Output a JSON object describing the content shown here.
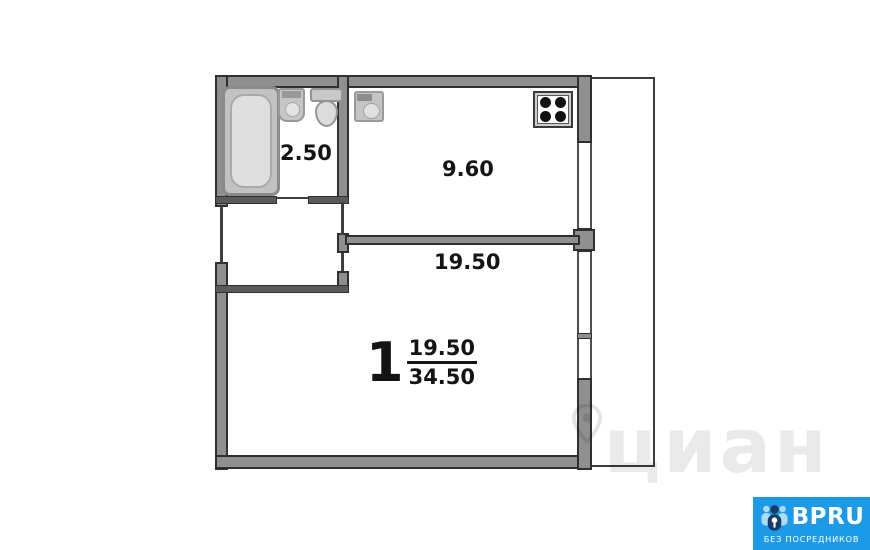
{
  "plan": {
    "rooms": [
      {
        "name": "bathroom",
        "area": "2.50"
      },
      {
        "name": "kitchen",
        "area": "9.60"
      },
      {
        "name": "living-room",
        "area": "19.50"
      }
    ],
    "summary": {
      "room_count": "1",
      "living_area": "19.50",
      "total_area": "34.50"
    },
    "fixtures": [
      "bathtub-icon",
      "washbasin-icon",
      "toilet-icon",
      "kitchen-sink-icon",
      "stove-icon"
    ]
  },
  "watermark": {
    "text": "циан",
    "icon": "location-pin-icon"
  },
  "logo": {
    "brand": "BPRU",
    "tagline": "БЕЗ ПОСРЕДНИКОВ",
    "icon": "people-icon"
  },
  "colors": {
    "wall_fill": "#8f8f8f",
    "wall_outline": "#2f2f2f",
    "badge_blue": "#1d9ae6",
    "badge_navy": "#173c68",
    "badge_light_blue": "#aadcf7",
    "label_text": "#141414"
  }
}
